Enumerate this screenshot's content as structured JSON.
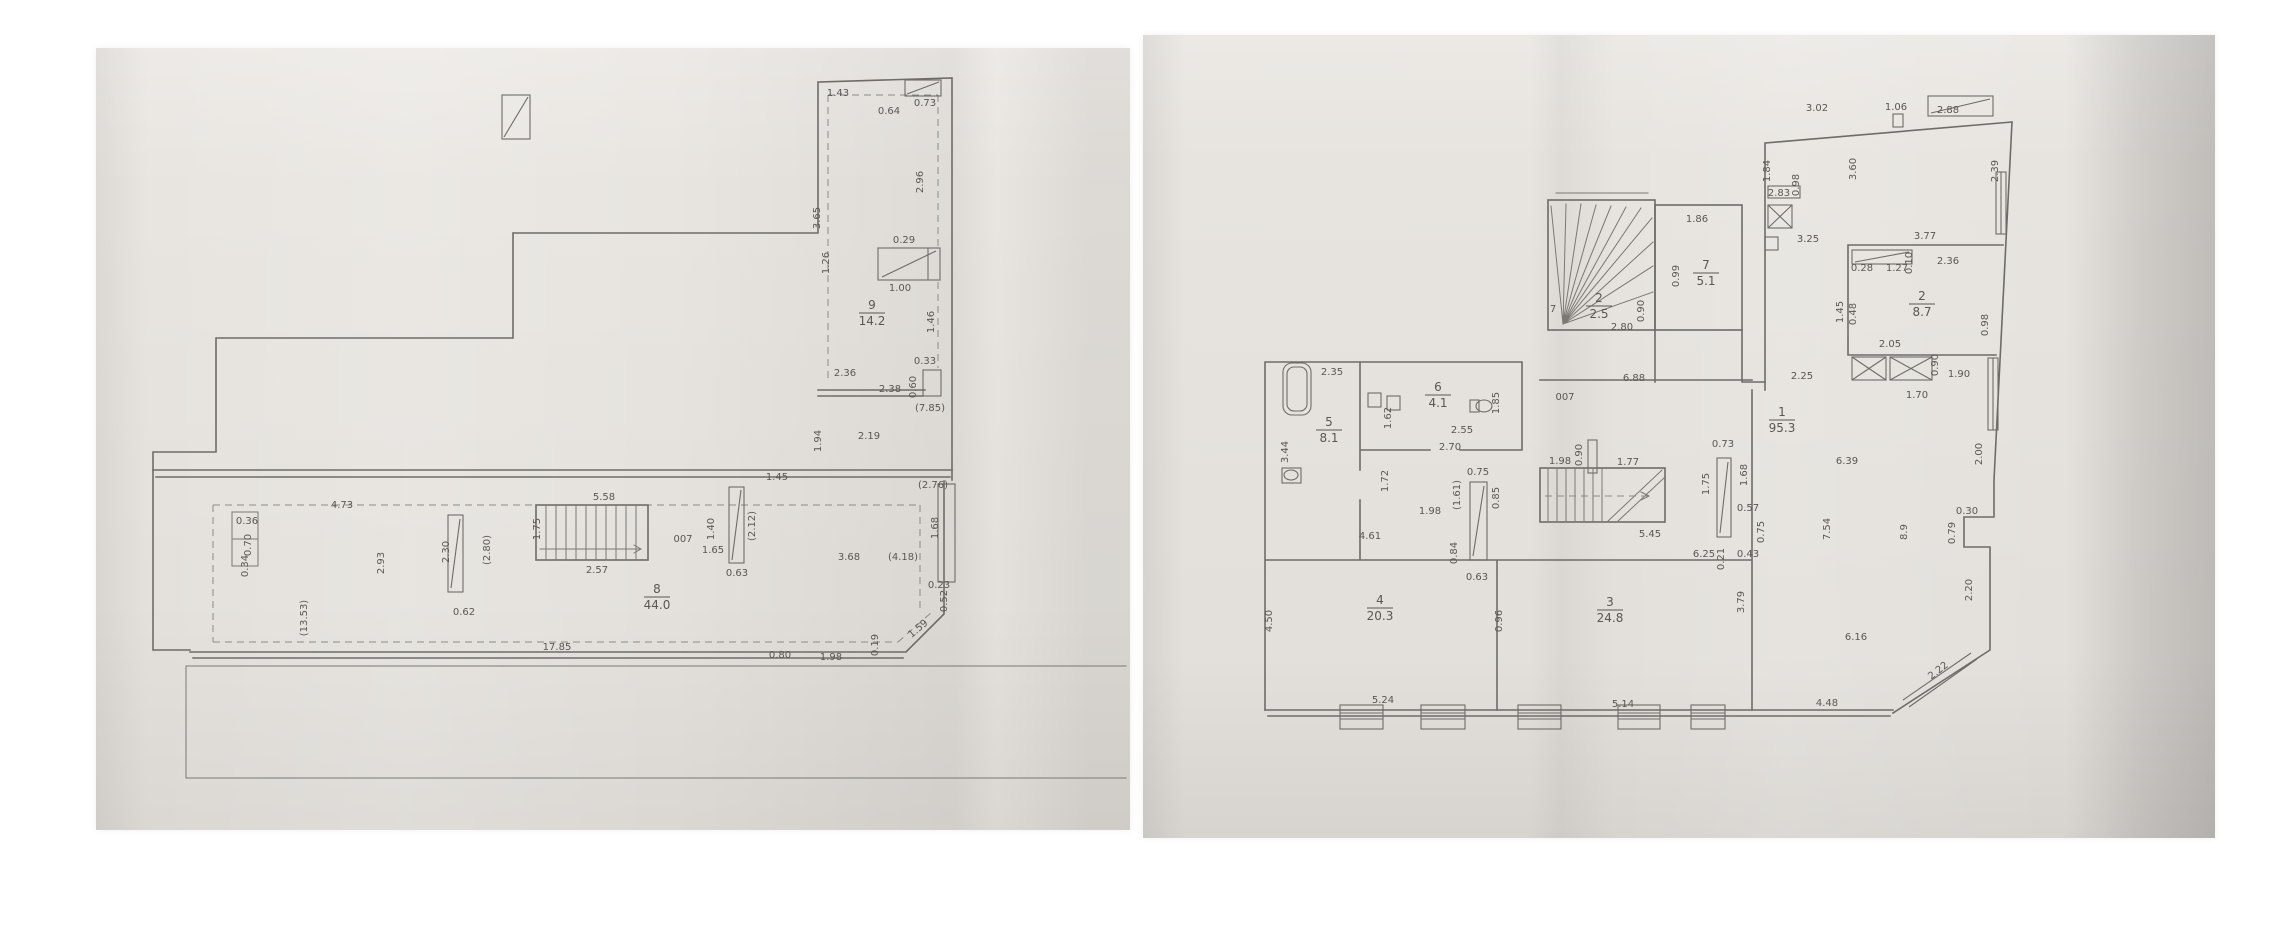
{
  "document_type": "scanned floor plan photos",
  "plans": [
    {
      "id": "plan-a",
      "rooms": [
        {
          "num": "9",
          "area": "14.2",
          "x": 872,
          "y": 312
        },
        {
          "num": "8",
          "area": "44.0",
          "x": 657,
          "y": 596
        }
      ],
      "labels": [
        {
          "t": "1.43",
          "x": 838,
          "y": 96,
          "s": 9
        },
        {
          "t": "0.64",
          "x": 889,
          "y": 114,
          "s": 8
        },
        {
          "t": "0.73",
          "x": 925,
          "y": 106,
          "s": 8
        },
        {
          "t": "3.65",
          "x": 820,
          "y": 218,
          "r": -90,
          "s": 9
        },
        {
          "t": "2.96",
          "x": 923,
          "y": 182,
          "r": -90,
          "s": 9
        },
        {
          "t": "1.26",
          "x": 829,
          "y": 263,
          "r": -90,
          "s": 8
        },
        {
          "t": "0.29",
          "x": 904,
          "y": 243,
          "s": 8
        },
        {
          "t": "1.00",
          "x": 900,
          "y": 291,
          "s": 8
        },
        {
          "t": "1.46",
          "x": 934,
          "y": 322,
          "r": -90,
          "s": 8
        },
        {
          "t": "0.33",
          "x": 925,
          "y": 364,
          "s": 8
        },
        {
          "t": "0.60",
          "x": 916,
          "y": 387,
          "r": -90,
          "s": 8
        },
        {
          "t": "2.36",
          "x": 845,
          "y": 376,
          "s": 9
        },
        {
          "t": "2.38",
          "x": 890,
          "y": 392,
          "s": 9
        },
        {
          "t": "(7.85)",
          "x": 930,
          "y": 411,
          "s": 8
        },
        {
          "t": "2.19",
          "x": 869,
          "y": 439,
          "s": 9
        },
        {
          "t": "1.94",
          "x": 821,
          "y": 441,
          "r": -90,
          "s": 8
        },
        {
          "t": "(2.76)",
          "x": 933,
          "y": 488,
          "s": 8
        },
        {
          "t": "1.68",
          "x": 938,
          "y": 528,
          "r": -90,
          "s": 8
        },
        {
          "t": "0.23",
          "x": 939,
          "y": 588,
          "s": 8
        },
        {
          "t": "0.52",
          "x": 947,
          "y": 601,
          "r": -90,
          "s": 8
        },
        {
          "t": "1.59",
          "x": 920,
          "y": 631,
          "r": -40,
          "s": 8
        },
        {
          "t": "0.80",
          "x": 780,
          "y": 658,
          "s": 8
        },
        {
          "t": "1.98",
          "x": 831,
          "y": 660,
          "s": 9
        },
        {
          "t": "0.19",
          "x": 878,
          "y": 645,
          "r": -90,
          "s": 8
        },
        {
          "t": "4.73",
          "x": 342,
          "y": 508,
          "s": 9
        },
        {
          "t": "0.36",
          "x": 247,
          "y": 524,
          "s": 8
        },
        {
          "t": "0.70",
          "x": 251,
          "y": 545,
          "r": -90,
          "s": 8
        },
        {
          "t": "0.34",
          "x": 248,
          "y": 566,
          "r": -90,
          "s": 8
        },
        {
          "t": "2.93",
          "x": 384,
          "y": 563,
          "r": -90,
          "s": 9
        },
        {
          "t": "(13.53)",
          "x": 307,
          "y": 618,
          "r": -90,
          "s": 8
        },
        {
          "t": "2.30",
          "x": 449,
          "y": 552,
          "r": -90,
          "s": 8
        },
        {
          "t": "(2.80)",
          "x": 490,
          "y": 550,
          "r": -90,
          "s": 8
        },
        {
          "t": "0.62",
          "x": 464,
          "y": 615,
          "s": 8
        },
        {
          "t": "5.58",
          "x": 604,
          "y": 500,
          "s": 9
        },
        {
          "t": "1.75",
          "x": 540,
          "y": 529,
          "r": -90,
          "s": 8
        },
        {
          "t": "2.57",
          "x": 597,
          "y": 573,
          "s": 9
        },
        {
          "t": "1.45",
          "x": 777,
          "y": 480,
          "s": 8
        },
        {
          "t": "1.40",
          "x": 714,
          "y": 529,
          "r": -90,
          "s": 8
        },
        {
          "t": "(2.12)",
          "x": 755,
          "y": 526,
          "r": -90,
          "s": 8
        },
        {
          "t": "1.65",
          "x": 713,
          "y": 553,
          "s": 8
        },
        {
          "t": "007",
          "x": 683,
          "y": 542,
          "s": 14
        },
        {
          "t": "0.63",
          "x": 737,
          "y": 576,
          "s": 8
        },
        {
          "t": "3.68",
          "x": 849,
          "y": 560,
          "s": 9
        },
        {
          "t": "(4.18)",
          "x": 903,
          "y": 560,
          "s": 8
        },
        {
          "t": "17.85",
          "x": 557,
          "y": 650,
          "s": 8
        }
      ]
    },
    {
      "id": "plan-b",
      "rooms": [
        {
          "num": "1",
          "area": "95.3",
          "x": 1782,
          "y": 419
        },
        {
          "num": "2",
          "area": "8.7",
          "x": 1922,
          "y": 303
        },
        {
          "num": "3",
          "area": "24.8",
          "x": 1610,
          "y": 609
        },
        {
          "num": "4",
          "area": "20.3",
          "x": 1380,
          "y": 607
        },
        {
          "num": "5",
          "area": "8.1",
          "x": 1329,
          "y": 429
        },
        {
          "num": "6",
          "area": "4.1",
          "x": 1438,
          "y": 394
        },
        {
          "num": "7",
          "area": "5.1",
          "x": 1706,
          "y": 272
        },
        {
          "num": "2",
          "area": "2.5",
          "x": 1599,
          "y": 305
        }
      ],
      "labels": [
        {
          "t": "7",
          "x": 1553,
          "y": 312,
          "s": 12
        },
        {
          "t": "3.02",
          "x": 1817,
          "y": 111,
          "s": 9
        },
        {
          "t": "1.06",
          "x": 1896,
          "y": 110,
          "s": 8
        },
        {
          "t": "2.88",
          "x": 1948,
          "y": 113,
          "s": 9
        },
        {
          "t": "1.84",
          "x": 1770,
          "y": 171,
          "r": -90,
          "s": 9
        },
        {
          "t": "3.60",
          "x": 1856,
          "y": 169,
          "r": -90,
          "s": 9
        },
        {
          "t": "2.39",
          "x": 1998,
          "y": 171,
          "r": -90,
          "s": 9
        },
        {
          "t": "2.83",
          "x": 1779,
          "y": 196,
          "s": 8
        },
        {
          "t": "0.98",
          "x": 1799,
          "y": 185,
          "r": -90,
          "s": 7
        },
        {
          "t": "3.25",
          "x": 1808,
          "y": 242,
          "s": 9
        },
        {
          "t": "3.77",
          "x": 1925,
          "y": 239,
          "s": 9
        },
        {
          "t": "0.28",
          "x": 1862,
          "y": 271,
          "s": 8
        },
        {
          "t": "1.27",
          "x": 1897,
          "y": 271,
          "s": 8
        },
        {
          "t": "0.10",
          "x": 1912,
          "y": 263,
          "r": -90,
          "s": 7
        },
        {
          "t": "2.36",
          "x": 1948,
          "y": 264,
          "s": 9
        },
        {
          "t": "1.45",
          "x": 1843,
          "y": 312,
          "r": -90,
          "s": 8
        },
        {
          "t": "0.48",
          "x": 1856,
          "y": 314,
          "r": -90,
          "s": 7
        },
        {
          "t": "0.98",
          "x": 1988,
          "y": 325,
          "r": -90,
          "s": 8
        },
        {
          "t": "2.05",
          "x": 1890,
          "y": 347,
          "s": 8
        },
        {
          "t": "0.90",
          "x": 1938,
          "y": 365,
          "r": -90,
          "s": 8
        },
        {
          "t": "1.90",
          "x": 1959,
          "y": 377,
          "s": 8
        },
        {
          "t": "1.70",
          "x": 1917,
          "y": 398,
          "s": 8
        },
        {
          "t": "1.86",
          "x": 1697,
          "y": 222,
          "s": 8
        },
        {
          "t": "0.99",
          "x": 1679,
          "y": 276,
          "r": -90,
          "s": 8
        },
        {
          "t": "0.90",
          "x": 1644,
          "y": 311,
          "r": -90,
          "s": 8
        },
        {
          "t": "2.80",
          "x": 1622,
          "y": 330,
          "s": 9
        },
        {
          "t": "2.35",
          "x": 1332,
          "y": 375,
          "s": 9
        },
        {
          "t": "3.44",
          "x": 1288,
          "y": 452,
          "r": -90,
          "s": 9
        },
        {
          "t": "1.62",
          "x": 1391,
          "y": 418,
          "r": -90,
          "s": 8
        },
        {
          "t": "1.85",
          "x": 1499,
          "y": 403,
          "r": -90,
          "s": 8
        },
        {
          "t": "2.55",
          "x": 1462,
          "y": 433,
          "s": 8
        },
        {
          "t": "2.70",
          "x": 1450,
          "y": 450,
          "s": 9
        },
        {
          "t": "007",
          "x": 1565,
          "y": 400,
          "s": 14
        },
        {
          "t": "6.88",
          "x": 1634,
          "y": 381,
          "s": 8
        },
        {
          "t": "0.75",
          "x": 1478,
          "y": 475,
          "s": 8
        },
        {
          "t": "1.72",
          "x": 1388,
          "y": 481,
          "r": -90,
          "s": 8
        },
        {
          "t": "(1.61)",
          "x": 1460,
          "y": 495,
          "r": -90,
          "s": 7
        },
        {
          "t": "1.98",
          "x": 1430,
          "y": 514,
          "s": 8
        },
        {
          "t": "0.85",
          "x": 1499,
          "y": 498,
          "r": -90,
          "s": 8
        },
        {
          "t": "4.61",
          "x": 1370,
          "y": 539,
          "s": 9
        },
        {
          "t": "0.84",
          "x": 1457,
          "y": 553,
          "r": -90,
          "s": 8
        },
        {
          "t": "0.63",
          "x": 1477,
          "y": 580,
          "s": 8
        },
        {
          "t": "0.90",
          "x": 1582,
          "y": 455,
          "r": -90,
          "s": 7
        },
        {
          "t": "1.98",
          "x": 1560,
          "y": 464,
          "s": 8
        },
        {
          "t": "1.77",
          "x": 1628,
          "y": 465,
          "s": 8
        },
        {
          "t": "5.45",
          "x": 1650,
          "y": 537,
          "s": 9
        },
        {
          "t": "0.73",
          "x": 1723,
          "y": 447,
          "s": 8
        },
        {
          "t": "1.68",
          "x": 1747,
          "y": 475,
          "r": -90,
          "s": 8
        },
        {
          "t": "1.75",
          "x": 1709,
          "y": 484,
          "r": -90,
          "s": 8
        },
        {
          "t": "0.57",
          "x": 1748,
          "y": 511,
          "s": 8
        },
        {
          "t": "0.75",
          "x": 1764,
          "y": 532,
          "r": -90,
          "s": 8
        },
        {
          "t": "6.25",
          "x": 1704,
          "y": 557,
          "s": 8
        },
        {
          "t": "0.21",
          "x": 1724,
          "y": 559,
          "r": -90,
          "s": 7
        },
        {
          "t": "0.43",
          "x": 1748,
          "y": 557,
          "s": 8
        },
        {
          "t": "3.79",
          "x": 1744,
          "y": 602,
          "r": -90,
          "s": 9
        },
        {
          "t": "2.25",
          "x": 1802,
          "y": 379,
          "s": 9
        },
        {
          "t": "6.39",
          "x": 1847,
          "y": 464,
          "s": 9
        },
        {
          "t": "7.54",
          "x": 1830,
          "y": 529,
          "r": -90,
          "s": 9
        },
        {
          "t": "8.9",
          "x": 1907,
          "y": 532,
          "r": -90,
          "s": 8
        },
        {
          "t": "0.30",
          "x": 1967,
          "y": 514,
          "s": 8
        },
        {
          "t": "0.79",
          "x": 1955,
          "y": 533,
          "r": -90,
          "s": 8
        },
        {
          "t": "2.00",
          "x": 1982,
          "y": 454,
          "r": -90,
          "s": 8
        },
        {
          "t": "2.20",
          "x": 1972,
          "y": 590,
          "r": -90,
          "s": 9
        },
        {
          "t": "6.16",
          "x": 1856,
          "y": 640,
          "s": 9
        },
        {
          "t": "2.22",
          "x": 1940,
          "y": 673,
          "r": -38,
          "s": 9
        },
        {
          "t": "4.48",
          "x": 1827,
          "y": 706,
          "s": 9
        },
        {
          "t": "4.50",
          "x": 1272,
          "y": 621,
          "r": -90,
          "s": 9
        },
        {
          "t": "5.24",
          "x": 1383,
          "y": 703,
          "s": 9
        },
        {
          "t": "0.96",
          "x": 1502,
          "y": 621,
          "r": -90,
          "s": 8
        },
        {
          "t": "5.14",
          "x": 1623,
          "y": 707,
          "s": 9
        }
      ]
    }
  ]
}
